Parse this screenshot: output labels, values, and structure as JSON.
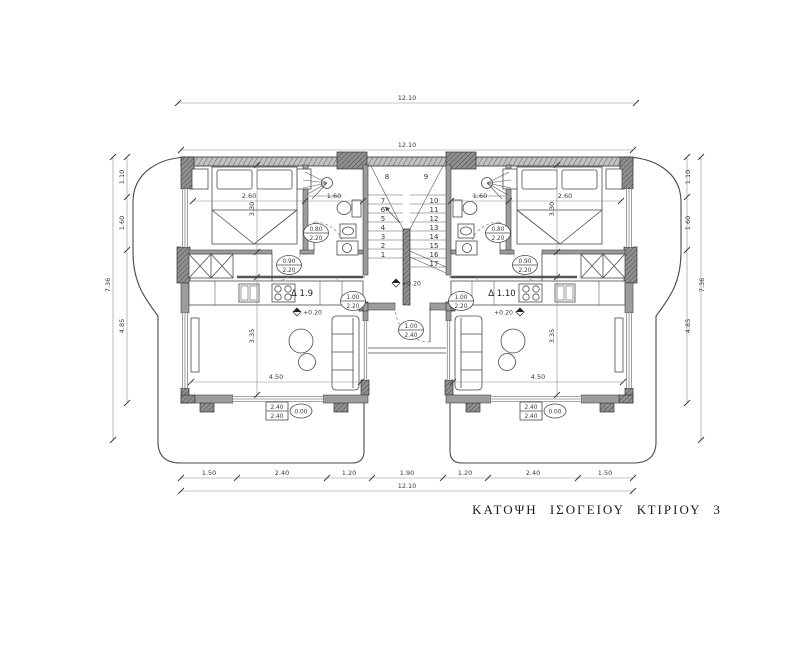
{
  "title": {
    "text": "ΚΑΤΟΨΗ ΙΣΟΓΕΙΟΥ ΚΤΙΡΙΟΥ 3"
  },
  "apartments": {
    "left": "Δ 1.9",
    "right": "Δ 1.10"
  },
  "levels": {
    "interior_left": "+0.20",
    "interior_right": "+0.20",
    "vestibule": "+0.20"
  },
  "dims": {
    "top_outer": "12.10",
    "top_inner": "12.10",
    "bottom_total": "12.10",
    "bottom_segments": [
      "1.50",
      "2.40",
      "1.20",
      "1.90",
      "1.20",
      "2.40",
      "1.50"
    ],
    "side_total": "7.36",
    "side_segments": [
      "1.10",
      "1.60",
      "4.85"
    ],
    "bedroom_width": "2.60",
    "bath_width": "1.60",
    "bedroom_depth": "3.30",
    "living_depth": "3.35",
    "living_width": "4.50"
  },
  "door_labels": {
    "bath": {
      "top": "0.80",
      "bottom": "2.20"
    },
    "bedroom": {
      "top": "0.90",
      "bottom": "2.20"
    },
    "apartment": {
      "top": "1.00",
      "bottom": "2.20"
    },
    "entrance": {
      "top": "1.00",
      "bottom": "2.40"
    }
  },
  "window_label": {
    "top": "2.40",
    "bottom": "2.40",
    "level": "0.00"
  },
  "stairs": {
    "numbers": [
      "1",
      "2",
      "3",
      "4",
      "5",
      "6",
      "7",
      "8",
      "9",
      "10",
      "11",
      "12",
      "13",
      "14",
      "15",
      "16",
      "17"
    ]
  }
}
